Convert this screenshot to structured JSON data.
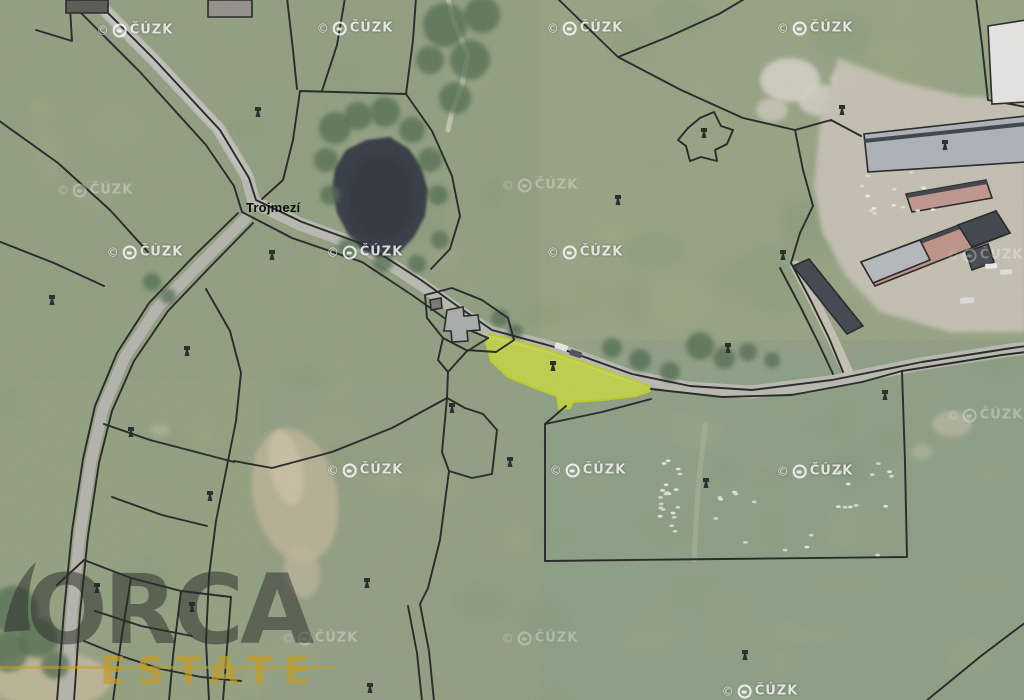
{
  "meta": {
    "width": 1024,
    "height": 700,
    "description": "Aerial cadastral map view with highlighted parcel"
  },
  "labels": {
    "place": {
      "text": "Trojmezí",
      "x": 246,
      "y": 200
    }
  },
  "watermark": {
    "symbol": "©",
    "text": "ČÚZK",
    "bright": [
      [
        135,
        30
      ],
      [
        355,
        28
      ],
      [
        585,
        28
      ],
      [
        815,
        28
      ],
      [
        145,
        252
      ],
      [
        365,
        252
      ],
      [
        585,
        252
      ],
      [
        365,
        470
      ],
      [
        588,
        470
      ],
      [
        815,
        471
      ],
      [
        760,
        691
      ]
    ],
    "faint": [
      [
        95,
        190
      ],
      [
        540,
        185
      ],
      [
        985,
        255
      ],
      [
        985,
        415
      ],
      [
        320,
        638
      ],
      [
        540,
        638
      ]
    ]
  },
  "logo": {
    "title": "ORCA",
    "subtitle": "ESTATE",
    "title_color": "rgba(45,45,42,0.52)",
    "subtitle_color": "rgba(198,156,34,0.68)",
    "line_color": "rgba(198,156,34,0.55)"
  },
  "palette": {
    "grass_base": "#8a9a7a",
    "road": "#b7b8ae",
    "pond": "#222c34",
    "farm_yard": "#c7c1b3",
    "highlight_fill": "rgba(205,224,45,0.78)",
    "highlight_stroke": "#bccf10",
    "parcel_line": "#101010"
  },
  "scene": {
    "tints": [
      {
        "x": 540,
        "y": 0,
        "w": 484,
        "h": 340,
        "c": "#a8b281",
        "o": 0.22
      },
      {
        "x": 540,
        "y": 360,
        "w": 484,
        "h": 340,
        "c": "#7d9a86",
        "o": 0.26
      },
      {
        "x": 0,
        "y": 380,
        "w": 260,
        "h": 320,
        "c": "#97a374",
        "o": 0.22
      },
      {
        "x": 0,
        "y": 0,
        "w": 560,
        "h": 380,
        "c": "#8d9c74",
        "o": 0.15
      }
    ],
    "mottle_colors": [
      "#9dab82",
      "#7b926c",
      "#a7ae7e",
      "#6e8a66",
      "#94a37b",
      "#879a72"
    ],
    "dirt": [
      {
        "cx": 295,
        "cy": 495,
        "rx": 42,
        "ry": 68,
        "rot": -12,
        "c": "#bdb193",
        "o": 0.85
      },
      {
        "cx": 286,
        "cy": 468,
        "rx": 16,
        "ry": 38,
        "rot": -12,
        "c": "#cfc3a3",
        "o": 0.8
      },
      {
        "cx": 302,
        "cy": 572,
        "rx": 18,
        "ry": 26,
        "rot": -8,
        "c": "#c0b497",
        "o": 0.7
      },
      {
        "cx": 50,
        "cy": 680,
        "rx": 62,
        "ry": 28,
        "rot": 0,
        "c": "#c4b695",
        "o": 0.85
      },
      {
        "cx": 952,
        "cy": 424,
        "rx": 20,
        "ry": 13,
        "rot": 0,
        "c": "#b5b39c",
        "o": 0.8
      },
      {
        "cx": 922,
        "cy": 452,
        "rx": 11,
        "ry": 8,
        "rot": 0,
        "c": "#b5b39c",
        "o": 0.6
      },
      {
        "cx": 160,
        "cy": 430,
        "rx": 10,
        "ry": 6,
        "rot": 0,
        "c": "#bdb69c",
        "o": 0.5
      },
      {
        "cx": 790,
        "cy": 80,
        "rx": 30,
        "ry": 22,
        "rot": 0,
        "c": "#d6d2c6",
        "o": 0.9
      },
      {
        "cx": 820,
        "cy": 100,
        "rx": 22,
        "ry": 16,
        "rot": 0,
        "c": "#d6d2c6",
        "o": 0.85
      },
      {
        "cx": 772,
        "cy": 110,
        "rx": 16,
        "ry": 12,
        "rot": 0,
        "c": "#cfcabc",
        "o": 0.8
      },
      {
        "cx": 845,
        "cy": 80,
        "rx": 14,
        "ry": 10,
        "rot": 0,
        "c": "#d9d5c9",
        "o": 0.8
      }
    ],
    "farm_yard": "838,58 900,82 962,96 1026,100 1026,332 950,332 880,312 846,276 822,232 814,186 820,120",
    "pond": "346,150 366,140 390,137 409,149 421,166 428,191 425,216 414,237 399,253 380,258 361,250 348,234 337,213 332,190 335,168",
    "trees": [
      [
        335,
        128,
        16
      ],
      [
        358,
        116,
        14
      ],
      [
        385,
        112,
        15
      ],
      [
        412,
        130,
        13
      ],
      [
        430,
        160,
        12
      ],
      [
        438,
        195,
        10
      ],
      [
        326,
        160,
        12
      ],
      [
        330,
        195,
        10
      ],
      [
        348,
        247,
        10
      ],
      [
        383,
        262,
        10
      ],
      [
        417,
        264,
        9
      ],
      [
        440,
        240,
        9
      ],
      [
        445,
        25,
        22
      ],
      [
        470,
        60,
        20
      ],
      [
        455,
        98,
        16
      ],
      [
        482,
        15,
        18
      ],
      [
        430,
        60,
        14
      ],
      [
        612,
        348,
        10
      ],
      [
        640,
        360,
        11
      ],
      [
        670,
        372,
        10
      ],
      [
        700,
        346,
        14
      ],
      [
        724,
        358,
        11
      ],
      [
        748,
        352,
        9
      ],
      [
        772,
        360,
        8
      ],
      [
        152,
        282,
        9
      ],
      [
        168,
        296,
        8
      ],
      [
        500,
        318,
        9
      ],
      [
        515,
        332,
        8
      ],
      [
        14,
        610,
        24
      ],
      [
        38,
        638,
        20
      ],
      [
        8,
        652,
        20
      ],
      [
        55,
        665,
        14
      ]
    ],
    "roads": [
      {
        "d": "M90,-5 L152,58 L218,128 L247,176 L254,202 L300,224 L366,248 L418,282 L460,312 L490,332 L560,350 L630,376 L688,388 L750,392 L830,382 L920,364 L1010,350 L1030,348",
        "w": 13,
        "c": "#b7b8ae",
        "o": 1
      },
      {
        "d": "M90,-5 L152,58 L218,128 L247,176",
        "w": 9,
        "c": "#c3c4ba",
        "o": 0.8
      },
      {
        "d": "M246,218 L203,261 L158,307 L125,357 L103,409 L91,461 L80,533 L72,612 L66,701",
        "w": 11,
        "c": "#b2b3a9",
        "o": 1
      },
      {
        "d": "M796,266 L815,303 L833,340 L848,373",
        "w": 11,
        "c": "#c6c0b0",
        "o": 1
      },
      {
        "d": "M705,425 L698,490 L694,560",
        "w": 5,
        "c": "#9fae8d",
        "o": 0.7
      },
      {
        "d": "M447,-5 L455,25 L468,55 L462,85 L452,112 L448,130",
        "w": 5,
        "c": "#c9cdb4",
        "o": 0.85
      }
    ],
    "highlight": {
      "pts": "489,334 502,337 548,350 602,369 649,386 650,391 636,396 602,400 573,402 570,408 559,409 557,396 537,389 508,377 491,361 486,343"
    },
    "parcel_lines": [
      "M92,-3 L155,60 L220,130 L249,178 L256,200 L302,222 L368,246 L421,280 L463,310 L492,330 L562,349 L632,374 L690,386 L752,390 L832,380 L922,362 L1012,348 L1026,346",
      "M74,6 L140,72 L206,145 L234,186 L242,212 L292,238 L362,262 L412,295 L450,322 L488,338",
      "M651,389 L722,397 L792,395 L862,382 L902,371 L1002,355 L1026,352",
      "M545,424 L602,412 L651,399 M902,371 L905,462 L907,557 L722,559 L545,561 L545,424",
      "M238,213 L194,256 L149,303 L117,353 L95,406 L83,459 L72,531 L64,611 L57,701",
      "M253,223 L211,266 L168,311 L134,361 L112,411 L99,463 L88,536 L80,613 L74,701",
      "M300,91 L406,94 M406,94 L432,131 L452,176 L460,216 L450,249 L431,269 M300,91 L293,140 L283,180 L262,199 M345,-2 L337,45 L322,91 M287,-2 L293,50 L297,89 M406,94 L413,40 L416,-2",
      "M-2,120 L58,163 L110,210 L148,252",
      "M-2,241 L54,263 L104,286 M36,30 L72,41 L70,8 M70,8 L108,6",
      "M557,-2 L590,30 L618,57 M618,57 L668,37 L719,14 L746,-2 M618,57 L681,90 L743,118 L795,130",
      "M795,130 L803,170 L813,206 L800,233 L791,263 M795,130 L831,120 L861,136 M791,263 L811,301 L829,338 L843,372 M780,268 L800,306 L818,342 L833,374",
      "M976,-2 L982,45 L988,100 L1026,107",
      "M700,118 L714,112 L721,126 L733,130 L727,144 L715,150 L717,161 L701,157 L690,161 L686,146 L678,140 L688,128 Z",
      "M425,295 L452,288 L482,300 L508,318 L514,340 L496,352 L466,350 L443,338 L427,318 Z M443,338 L438,360 L448,372 M448,372 L447,398",
      "M447,398 L442,452 L449,471 L472,478 L492,474 L497,430 L483,414 L465,408 Z M447,398 L392,428 L332,452 L272,468 L234,461",
      "M206,289 L230,331 L241,373 L236,421 L226,471 L216,521 L209,576 L206,641 L209,701",
      "M104,424 L150,440 L196,452 L234,462 M112,497 L162,515 L207,526",
      "M84,560 L131,578 L181,591 L231,597 M95,611 L141,626 L192,636 M131,578 L121,641 L113,701 M181,591 L173,656 L169,701 M231,597 L226,661 L223,701 M84,641 L121,656 L161,669 L201,677 L241,681 M57,585 L84,560",
      "M408,606 L417,653 L422,701 M420,604 L429,651 L434,701 M449,471 L440,540 L428,588 L420,604",
      "M926,701 L981,656 L1026,622",
      "M566,406 L552,418 L545,424 M488,338 L466,352 L448,372"
    ],
    "buildings": [
      {
        "pts": "66,0 108,0 108,13 66,13",
        "f": "#4a4a46"
      },
      {
        "pts": "208,0 252,0 252,17 208,17",
        "f": "#8e8a82"
      },
      {
        "pts": "988,26 1026,20 1026,102 992,104",
        "f": "#e9eae8"
      },
      {
        "pts": "864,134 1026,116 1026,162 868,172",
        "f": "#a9b0b5",
        "ridge": "M864,141 L1026,124"
      },
      {
        "pts": "906,194 986,180 992,198 912,212",
        "f": "#c09188",
        "ridge": "M907,196 L987,182"
      },
      {
        "pts": "861,262 996,211 1010,233 875,286",
        "f": "#bd8d80",
        "ridge": "M862,264 L997,213"
      },
      {
        "pts": "861,262 920,240 930,260 873,283",
        "f": "#b3b8bb"
      },
      {
        "pts": "958,225 996,211 1010,233 972,247",
        "f": "#2d333d"
      },
      {
        "pts": "966,252 988,244 994,262 972,270",
        "f": "#343a42"
      },
      {
        "pts": "793,266 809,259 863,326 847,334",
        "f": "#2f3640"
      },
      {
        "pts": "447,310 463,307 464,316 478,315 480,330 467,331 468,341 452,342 451,331 444,331",
        "f": "#a7aaa8"
      },
      {
        "pts": "430,300 441,298 442,308 431,310",
        "f": "#6b6e6c"
      }
    ],
    "vehicles": [
      {
        "x": 556,
        "y": 342,
        "w": 13,
        "h": 6,
        "r": 18,
        "c": "#ececea"
      },
      {
        "x": 571,
        "y": 349,
        "w": 12,
        "h": 6,
        "r": 18,
        "c": "#3c4146"
      },
      {
        "x": 985,
        "y": 264,
        "w": 12,
        "h": 5,
        "r": -4,
        "c": "#f0f0ee"
      },
      {
        "x": 1000,
        "y": 270,
        "w": 12,
        "h": 5,
        "r": -4,
        "c": "#e4e4e0"
      },
      {
        "x": 960,
        "y": 298,
        "w": 14,
        "h": 6,
        "r": -4,
        "c": "#dfe0da"
      }
    ],
    "sheep_clusters": [
      {
        "x": 660,
        "y": 450,
        "w": 22,
        "h": 85,
        "n": 20
      },
      {
        "x": 700,
        "y": 458,
        "w": 195,
        "h": 100,
        "n": 22
      },
      {
        "x": 862,
        "y": 172,
        "w": 80,
        "h": 48,
        "n": 14
      }
    ],
    "markers": [
      [
        258,
        112
      ],
      [
        272,
        255
      ],
      [
        187,
        351
      ],
      [
        131,
        432
      ],
      [
        210,
        496
      ],
      [
        97,
        588
      ],
      [
        192,
        607
      ],
      [
        367,
        583
      ],
      [
        452,
        408
      ],
      [
        510,
        462
      ],
      [
        553,
        366
      ],
      [
        618,
        200
      ],
      [
        704,
        133
      ],
      [
        842,
        110
      ],
      [
        783,
        255
      ],
      [
        728,
        348
      ],
      [
        945,
        145
      ],
      [
        706,
        483
      ],
      [
        745,
        655
      ],
      [
        370,
        688
      ],
      [
        52,
        300
      ],
      [
        885,
        395
      ]
    ]
  }
}
